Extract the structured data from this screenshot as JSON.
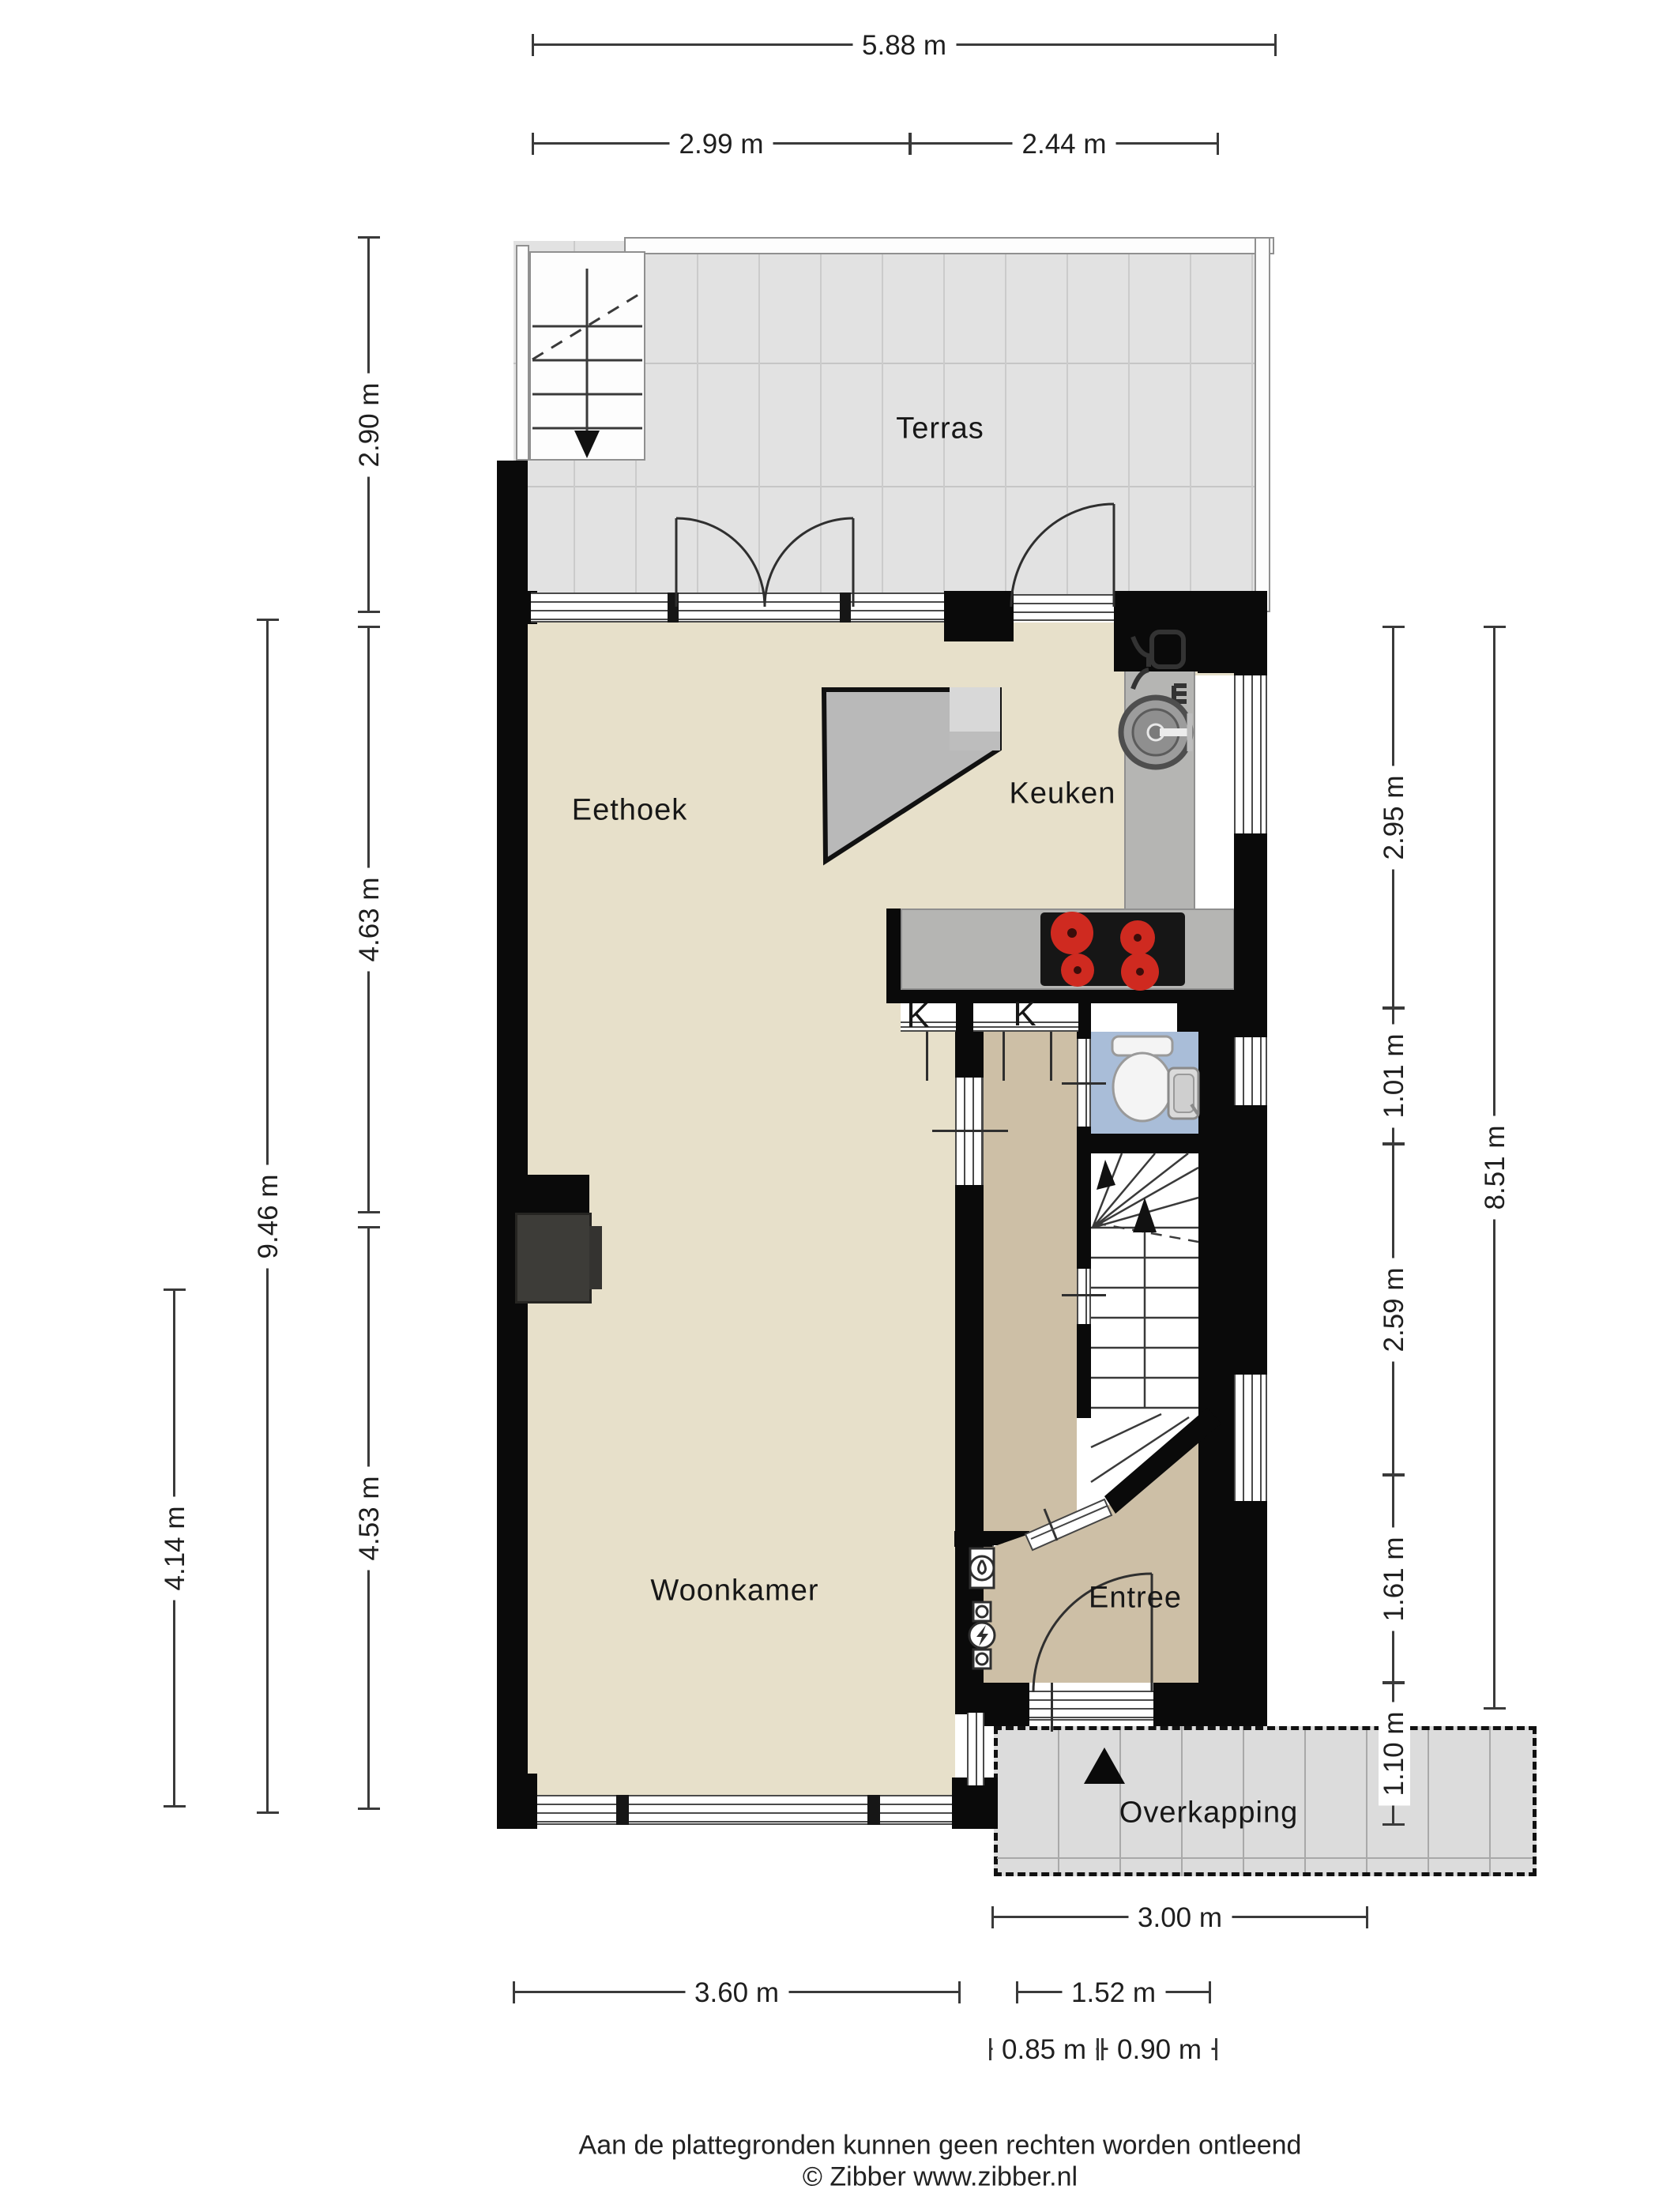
{
  "rooms": {
    "terras": {
      "label": "Terras"
    },
    "eethoek": {
      "label": "Eethoek"
    },
    "keuken": {
      "label": "Keuken"
    },
    "woonkamer": {
      "label": "Woonkamer"
    },
    "entree": {
      "label": "Entree"
    },
    "overkapping": {
      "label": "Overkapping"
    }
  },
  "markers": {
    "k_left": "K",
    "k_right": "K"
  },
  "dimensions": {
    "top": [
      {
        "label": "5.88 m"
      },
      {
        "label": "2.99 m"
      },
      {
        "label": "2.44 m"
      }
    ],
    "left": [
      {
        "label": "2.90 m"
      },
      {
        "label": "4.63 m"
      },
      {
        "label": "4.53 m"
      },
      {
        "label": "9.46 m"
      },
      {
        "label": "4.14 m"
      }
    ],
    "right": [
      {
        "label": "2.95 m"
      },
      {
        "label": "1.01 m"
      },
      {
        "label": "2.59 m"
      },
      {
        "label": "1.61 m"
      },
      {
        "label": "1.10 m"
      },
      {
        "label": "8.51 m"
      }
    ],
    "bottom": [
      {
        "label": "3.00 m"
      },
      {
        "label": "3.60 m"
      },
      {
        "label": "1.52 m"
      },
      {
        "label": "0.85 m"
      },
      {
        "label": "0.90 m"
      }
    ]
  },
  "footer": {
    "line1": "Aan de plattegronden kunnen geen rechten worden ontleend",
    "line2": "© Zibber www.zibber.nl"
  },
  "colors": {
    "wall": "#0a0a0a",
    "floor_living": "#e7e0ca",
    "floor_hall": "#cdbfa6",
    "floor_toilet": "#a9bdd8",
    "terrace": "#e2e2e2",
    "canopy": "#dcdcdc",
    "counter": "#b5b5b3",
    "burner": "#cf2a20"
  }
}
